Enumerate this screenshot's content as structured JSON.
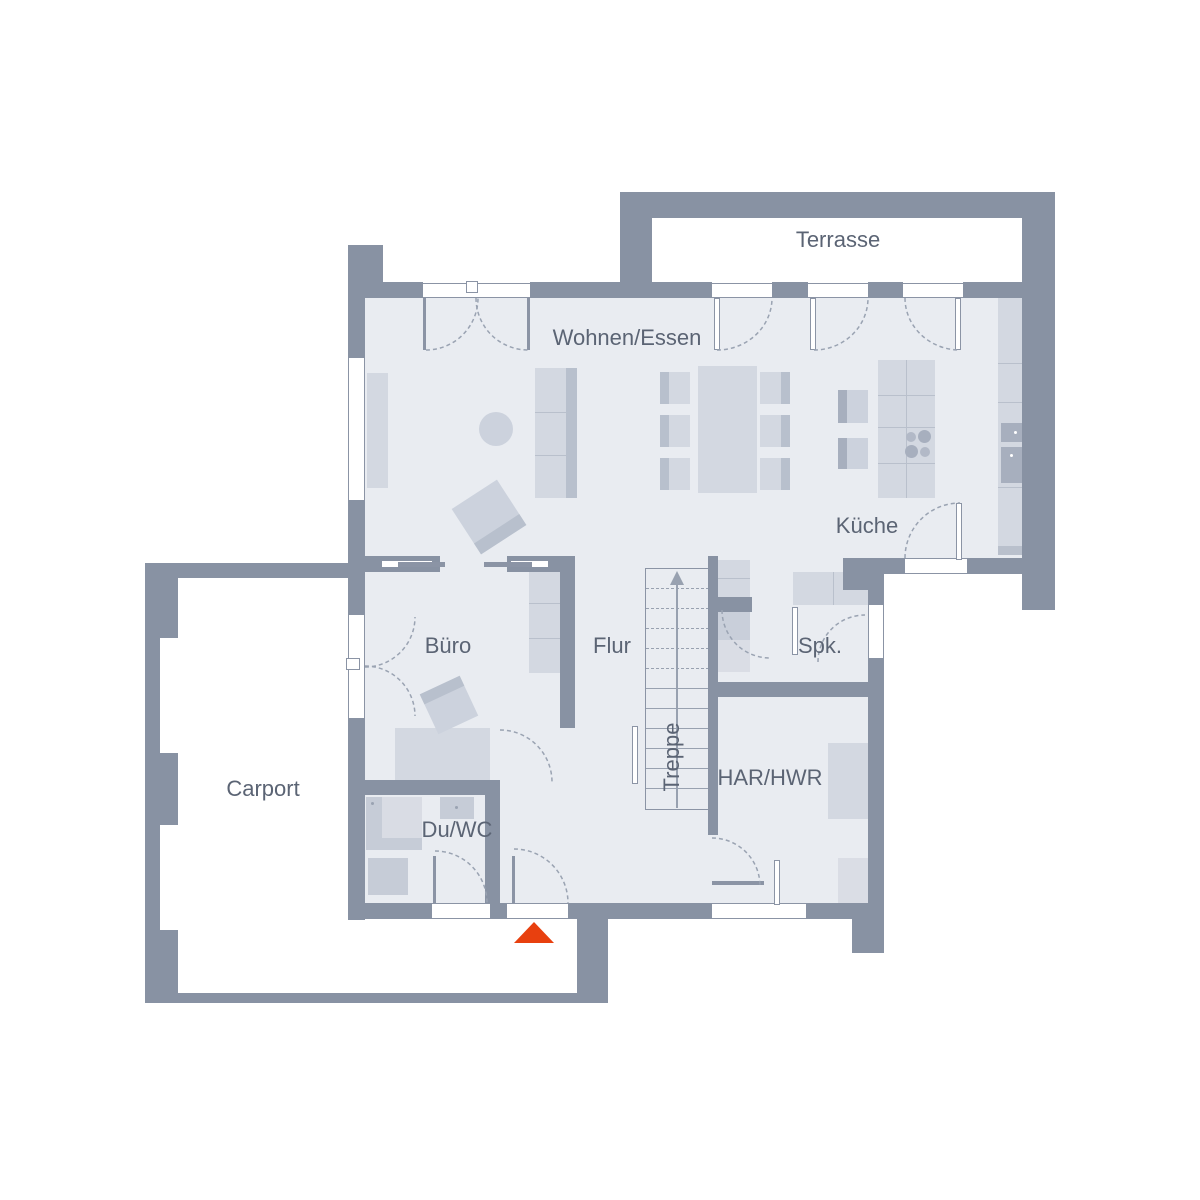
{
  "title": "Erdgeschoss Grundriss",
  "rooms": {
    "terrasse": "Terrasse",
    "wohnen_essen": "Wohnen/Essen",
    "kueche": "Küche",
    "buero": "Büro",
    "flur": "Flur",
    "treppe": "Treppe",
    "spk": "Spk.",
    "har_hwr": "HAR/HWR",
    "du_wc": "Du/WC",
    "carport": "Carport"
  },
  "colors": {
    "wall": "#8892a3",
    "floor": "#e9ecf1",
    "furniture_light": "#d3d8e1",
    "furniture_mid": "#b8c0cd",
    "furniture_dark": "#a7afbe",
    "window_frame": "#8b94a5",
    "door_swing": "#9aa3b2",
    "label_text": "#5b6474",
    "accent_entrance_arrow": "#e8400f",
    "background": "#ffffff"
  },
  "icons": {
    "entrance_arrow": "entrance-direction-marker",
    "stairs_arrow": "stairs-up-direction"
  }
}
